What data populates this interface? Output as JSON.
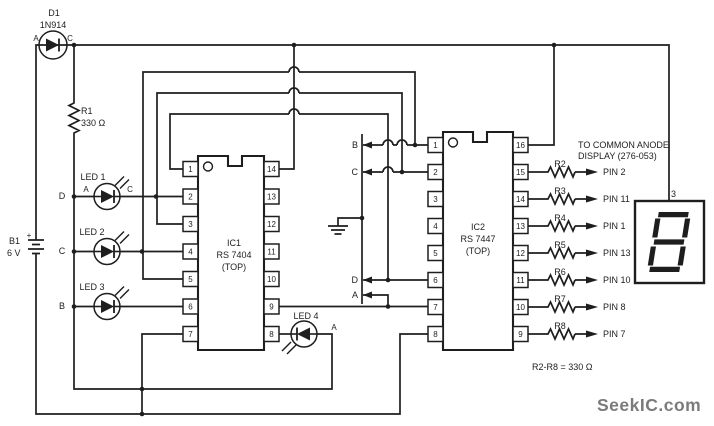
{
  "colors": {
    "ink": "#1e1e1e",
    "paper": "#ffffff",
    "watermark_gray": "#7b7b7b"
  },
  "diode": {
    "ref": "D1",
    "part": "1N914",
    "anode": "A",
    "cathode": "C"
  },
  "battery": {
    "ref": "B1",
    "voltage": "6 V",
    "plus": "+"
  },
  "r1": {
    "ref": "R1",
    "value": "330 Ω"
  },
  "bus": {
    "d": "D",
    "c": "C",
    "b": "B"
  },
  "leds": {
    "led1": {
      "label": "LED 1",
      "a": "A",
      "c": "C"
    },
    "led2": {
      "label": "LED 2"
    },
    "led3": {
      "label": "LED 3"
    },
    "led4": {
      "label": "LED 4",
      "a": "A"
    }
  },
  "ic1": {
    "ref": "IC1",
    "part": "RS 7404",
    "orient": "(TOP)",
    "left_pins": [
      "1",
      "2",
      "3",
      "4",
      "5",
      "6",
      "7"
    ],
    "right_pins": [
      "14",
      "13",
      "12",
      "11",
      "10",
      "9",
      "8"
    ]
  },
  "ic2": {
    "ref": "IC2",
    "part": "RS 7447",
    "orient": "(TOP)",
    "left_pins": [
      "1",
      "2",
      "3",
      "4",
      "5",
      "6",
      "7",
      "8"
    ],
    "right_pins": [
      "16",
      "15",
      "14",
      "13",
      "12",
      "11",
      "10",
      "9"
    ]
  },
  "signals": {
    "b": "B",
    "c": "C",
    "d": "D",
    "a": "A"
  },
  "display_note": {
    "line1": "TO COMMON ANODE",
    "line2": "DISPLAY (276-053)"
  },
  "output_resistors": [
    {
      "ref": "R2",
      "pin": "PIN 2"
    },
    {
      "ref": "R3",
      "pin": "PIN 11"
    },
    {
      "ref": "R4",
      "pin": "PIN 1"
    },
    {
      "ref": "R5",
      "pin": "PIN 13"
    },
    {
      "ref": "R6",
      "pin": "PIN 10"
    },
    {
      "ref": "R7",
      "pin": "PIN 8"
    },
    {
      "ref": "R8",
      "pin": "PIN 7"
    }
  ],
  "resistor_note": "R2-R8 = 330 Ω",
  "seven_segment": {
    "pin_label": "3"
  },
  "watermark": "SeekIC.com"
}
